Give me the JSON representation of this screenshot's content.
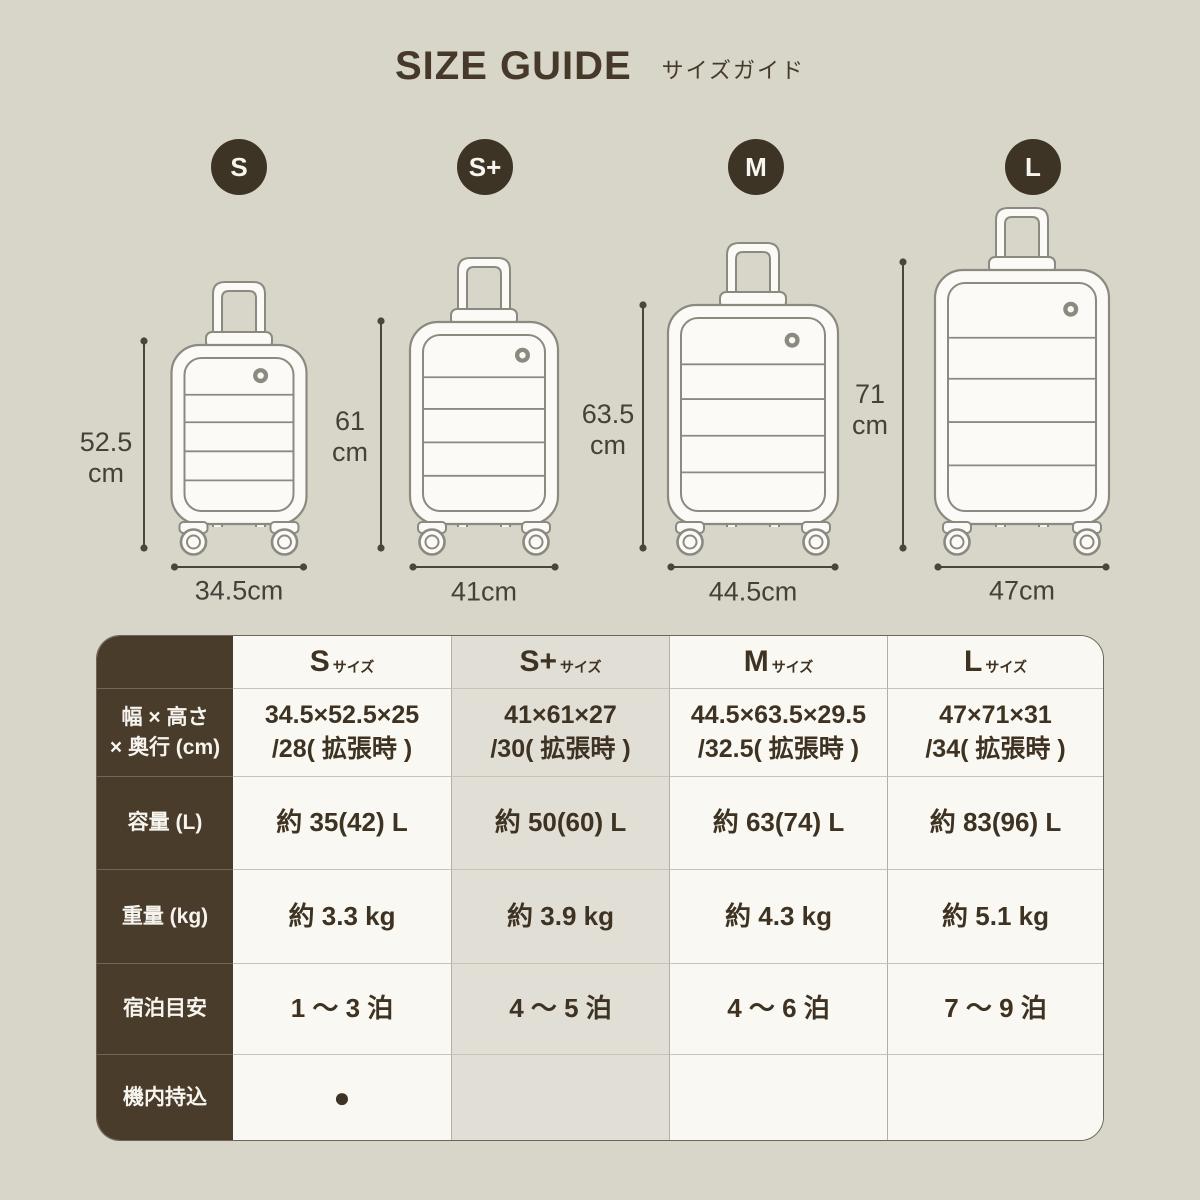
{
  "header": {
    "title_en": "SIZE GUIDE",
    "title_ja": "サイズガイド"
  },
  "colors": {
    "page_bg": "#D8D6C9",
    "brand_dark": "#3E3426",
    "table_label_bg": "#4A3C2A",
    "highlight_column_bg": "#E0DED5",
    "cell_bg": "#F9F8F3",
    "line_gray": "#8C8A80",
    "dimension_line": "#4B463C"
  },
  "sizes": [
    {
      "id": "s",
      "badge": "S",
      "height_label": "52.5\ncm",
      "width_label": "34.5cm"
    },
    {
      "id": "s-plus",
      "badge": "S+",
      "height_label": "61\ncm",
      "width_label": "41cm"
    },
    {
      "id": "m",
      "badge": "M",
      "height_label": "63.5\ncm",
      "width_label": "44.5cm"
    },
    {
      "id": "l",
      "badge": "L",
      "height_label": "71\ncm",
      "width_label": "47cm"
    }
  ],
  "table": {
    "columns": [
      {
        "name": "S",
        "suffix": "サイズ",
        "highlighted": false
      },
      {
        "name": "S+",
        "suffix": "サイズ",
        "highlighted": true
      },
      {
        "name": "M",
        "suffix": "サイズ",
        "highlighted": false
      },
      {
        "name": "L",
        "suffix": "サイズ",
        "highlighted": false
      }
    ],
    "rows": [
      {
        "label": "幅 × 高さ\n× 奥行 (cm)",
        "values": [
          "34.5×52.5×25\n/28( 拡張時 )",
          "41×61×27\n/30( 拡張時 )",
          "44.5×63.5×29.5\n/32.5( 拡張時 )",
          "47×71×31\n/34( 拡張時 )"
        ]
      },
      {
        "label": "容量 (L)",
        "values": [
          "約 35(42) L",
          "約 50(60) L",
          "約 63(74) L",
          "約 83(96) L"
        ]
      },
      {
        "label": "重量 (kg)",
        "values": [
          "約 3.3 kg",
          "約 3.9 kg",
          "約 4.3 kg",
          "約 5.1 kg"
        ]
      },
      {
        "label": "宿泊目安",
        "values": [
          "1 〜 3 泊",
          "4 〜 5 泊",
          "4 〜 6 泊",
          "7 〜 9 泊"
        ]
      },
      {
        "label": "機内持込",
        "values": [
          "●",
          "",
          "",
          ""
        ]
      }
    ]
  }
}
